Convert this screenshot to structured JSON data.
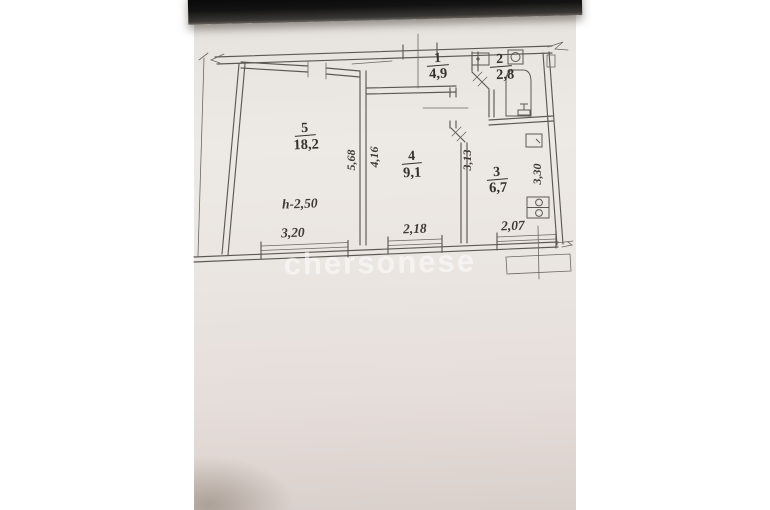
{
  "photo": {
    "watermark": "chersonese"
  },
  "floor_plan": {
    "rooms": [
      {
        "id": "room-5",
        "number": "5",
        "area": "18,2"
      },
      {
        "id": "room-4",
        "number": "4",
        "area": "9,1"
      },
      {
        "id": "room-3",
        "number": "3",
        "area": "6,7"
      },
      {
        "id": "room-1",
        "number": "1",
        "area": "4,9"
      },
      {
        "id": "room-2",
        "number": "2",
        "area": "2,8"
      }
    ],
    "ceiling_height": "h-2,50",
    "width_dimensions": [
      "3,20",
      "2,18",
      "2,07"
    ],
    "depth_dimensions": [
      "5,68",
      "4,16",
      "3,13",
      "3,30"
    ]
  },
  "colors": {
    "paper": "#eae5e1",
    "line": "#5d5852",
    "text": "#36312c",
    "background_band": "#0a0a0a",
    "watermark": "#ffffff"
  }
}
